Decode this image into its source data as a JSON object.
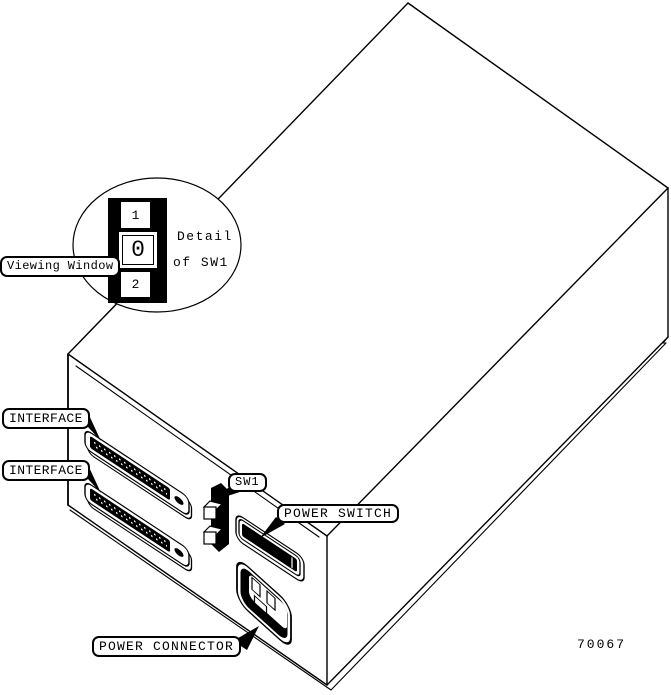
{
  "colors": {
    "ink": "#000000",
    "paper": "#ffffff"
  },
  "callouts": {
    "viewing_window": "Viewing Window",
    "interface_top": "INTERFACE",
    "interface_bottom": "INTERFACE",
    "sw1": "SW1",
    "power_switch": "POWER SWITCH",
    "power_connector": "POWER CONNECTOR"
  },
  "detail_view": {
    "caption_line1": "Detail",
    "caption_line2": "of SW1",
    "switch_positions": {
      "top": "1",
      "middle": "0",
      "bottom": "2"
    }
  },
  "figure_number": "70067"
}
